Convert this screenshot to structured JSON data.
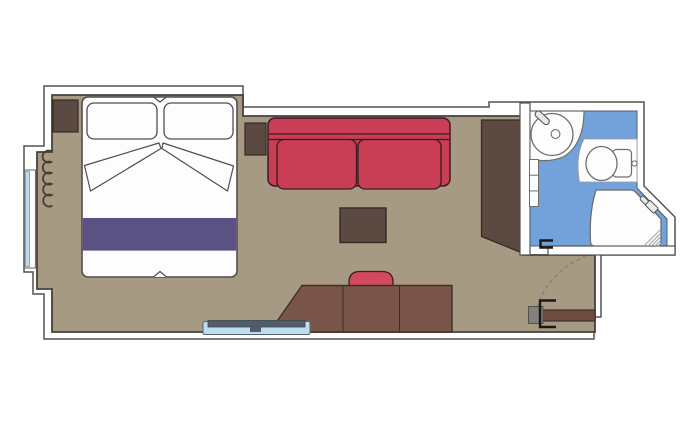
{
  "meta": {
    "type": "cabin-floor-plan",
    "canvas": {
      "width": 697,
      "height": 431
    }
  },
  "palette": {
    "wall_fill": "#ffffff",
    "wall_line": "#55524e",
    "floor": "#a69a83",
    "floor_line": "#45413c",
    "furniture_dark": "#5c4941",
    "furniture_dark_line": "#342b25",
    "desk": "#7a5549",
    "desk_line": "#3c2f28",
    "door_leaf": "#6f4c3f",
    "sofa_red": "#c93d55",
    "sofa_line": "#381d24",
    "stool_red": "#d24960",
    "bed_white": "#fdfdfd",
    "bed_line": "#4f4f4f",
    "duvet_purple": "#5a5284",
    "bath_blue": "#72a2d9",
    "bath_blue_line": "#4d5e7d",
    "fixture_white": "#fdfdfd",
    "fixture_line": "#6e6e6e",
    "fixture_dark": "#555555",
    "faucet_fill": "#e9e9e9",
    "glass_blue": "#bcdcf2",
    "tv_gray": "#515d69",
    "hatch": "#a0a6ad",
    "handle_black": "#181818",
    "hinge_gray": "#84807a",
    "swing_dash": "#8b8174",
    "curtain": "#4a3b33"
  },
  "inventory": {
    "bedroom": [
      "double-bed",
      "pillow-left",
      "pillow-right",
      "folded-sheets",
      "duvet-runner",
      "nightstand-left",
      "nightstand-right",
      "curtain",
      "balcony-window"
    ],
    "living": [
      "sofa",
      "coffee-table",
      "stool",
      "desk",
      "tv-panel",
      "wardrobe"
    ],
    "bathroom": [
      "washbasin",
      "faucet",
      "shelf-unit",
      "toilet",
      "cistern",
      "flush-button",
      "shower",
      "shower-head",
      "door-handle"
    ],
    "entrance": [
      "entrance-door-leaf",
      "door-hinge-block",
      "door-handle",
      "door-swing-arc"
    ]
  }
}
